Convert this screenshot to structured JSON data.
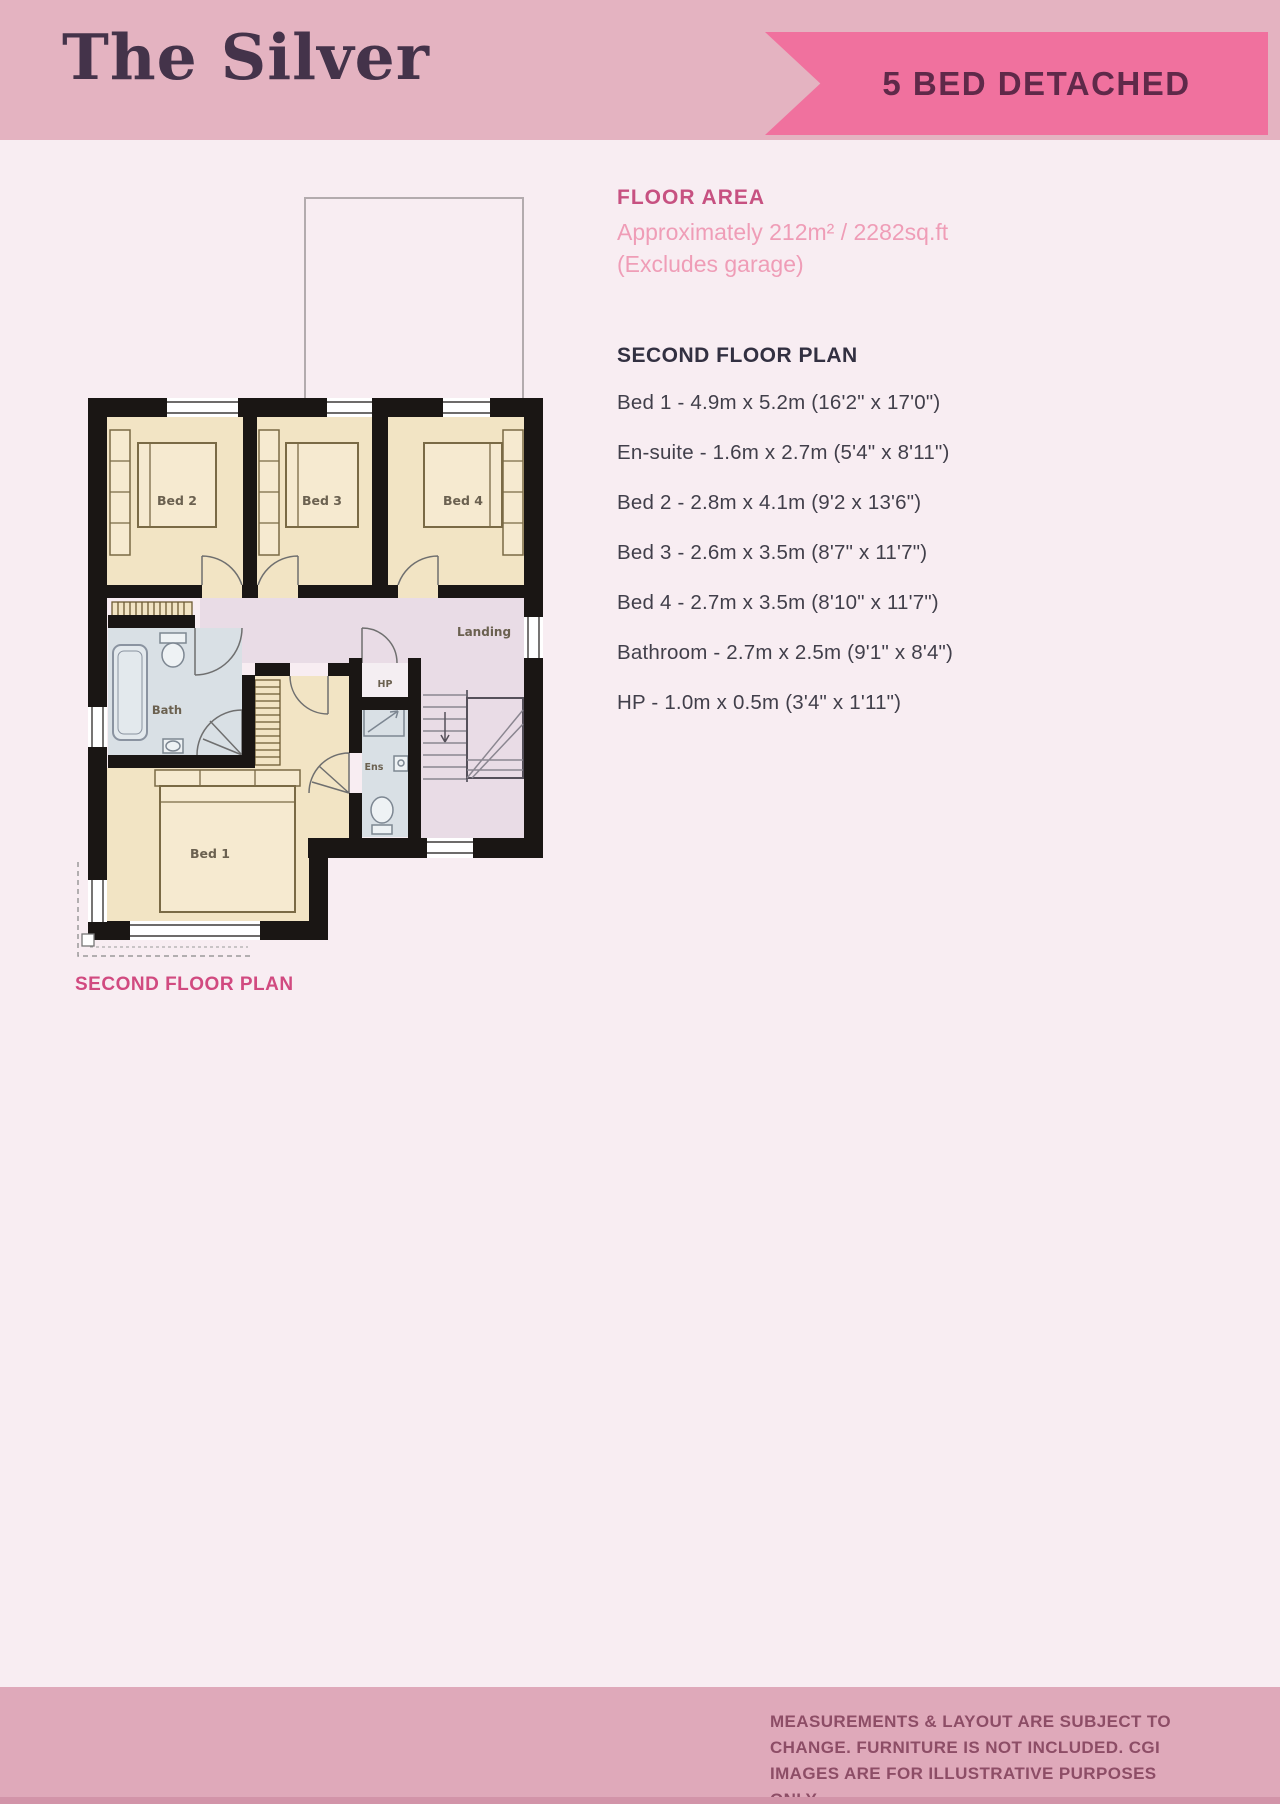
{
  "header": {
    "title": "The Silver",
    "badge": "5 BED DETACHED"
  },
  "floor_area": {
    "heading": "FLOOR AREA",
    "approx": "Approximately 212m² / 2282sq.ft",
    "excludes": "(Excludes garage)"
  },
  "plan_details": {
    "heading": "SECOND FLOOR PLAN",
    "rooms": [
      "Bed 1 - 4.9m x 5.2m (16'2\" x 17'0\")",
      "En-suite - 1.6m x 2.7m (5'4\" x 8'11\")",
      "Bed 2 - 2.8m x 4.1m (9'2 x 13'6\")",
      "Bed 3 - 2.6m x 3.5m (8'7\" x 11'7\")",
      "Bed 4 - 2.7m x 3.5m (8'10\" x 11'7\")",
      "Bathroom - 2.7m x 2.5m (9'1\" x 8'4\")",
      "HP - 1.0m x 0.5m (3'4\" x 1'11\")"
    ]
  },
  "plan": {
    "caption": "SECOND FLOOR PLAN",
    "labels": {
      "bed1": "Bed 1",
      "bed2": "Bed 2",
      "bed3": "Bed 3",
      "bed4": "Bed 4",
      "bath": "Bath",
      "ens": "Ens",
      "hp": "HP",
      "landing": "Landing"
    }
  },
  "footer": {
    "disclaimer": "MEASUREMENTS & LAYOUT ARE SUBJECT TO CHANGE. FURNITURE IS NOT INCLUDED. CGI IMAGES ARE FOR ILLUSTRATIVE PURPOSES ONLY"
  },
  "colors": {
    "header_pink": "#e4b3c1",
    "badge_pink": "#f0719e",
    "badge_text": "#5f2949",
    "title_plum": "#44334a",
    "page_bg": "#f8edf2",
    "accent_magenta": "#c75181",
    "light_pink_text": "#ef9db7",
    "caption_pink": "#d14a80",
    "footer_pink": "#dfa9ba",
    "footer_text": "#8d4d66",
    "wall_black": "#1a1614",
    "room_cream": "#f2e4c4",
    "landing_lavender": "#e9dce6",
    "bath_blue": "#d9e0e5"
  }
}
